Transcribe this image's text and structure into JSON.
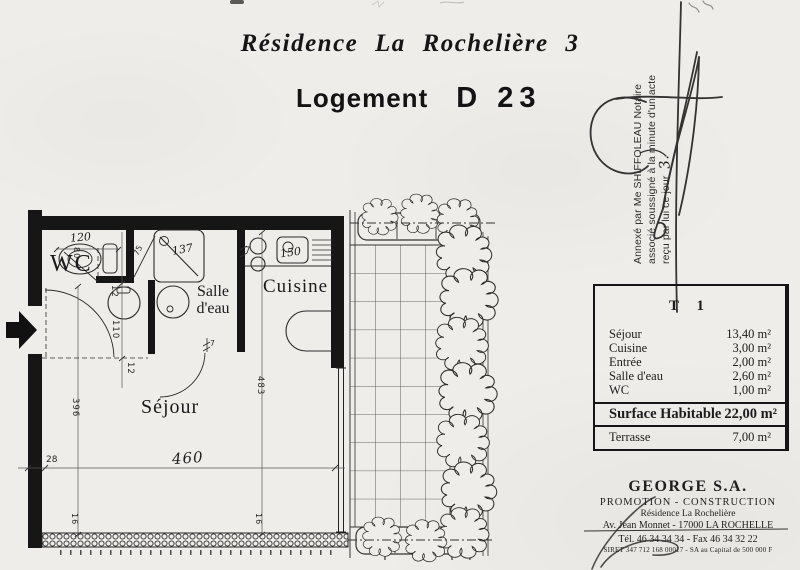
{
  "page": {
    "title": "Résidence La Rochelière 3",
    "logement_label": "Logement",
    "logement_number": "D 23"
  },
  "notary": {
    "line1": "Annexé par Me SHIFFOLEAU Notaire",
    "line2": "associé soussigné à la minute d'un acte",
    "line3": "reçu par lui ce jour",
    "handwritten": "3."
  },
  "plan": {
    "labels": {
      "wc": "WC",
      "salle_line1": "Salle",
      "salle_line2": "d'eau",
      "cuisine": "Cuisine",
      "sejour": "Séjour"
    },
    "dims": {
      "toilet_width": "120",
      "toilet_depth": "80",
      "door_wc": "75",
      "shower": "137",
      "wall_a": "7",
      "sink": "150",
      "d12_top": "12",
      "entry_width": "110",
      "d12_bottom": "12",
      "entry_height": "396",
      "sejour_height": "483",
      "sejour_width": "460",
      "d28": "28",
      "window_left": "16",
      "window_right": "16",
      "wall_b": "7"
    }
  },
  "table": {
    "header": "T 1",
    "rows": [
      {
        "label": "Séjour",
        "value": "13,40 m²"
      },
      {
        "label": "Cuisine",
        "value": "3,00 m²"
      },
      {
        "label": "Entrée",
        "value": "2,00 m²"
      },
      {
        "label": "Salle d'eau",
        "value": "2,60 m²"
      },
      {
        "label": "WC",
        "value": "1,00 m²"
      }
    ],
    "total": {
      "label": "Surface Habitable",
      "value": "22,00 m²"
    },
    "terrace": {
      "label": "Terrasse",
      "value": "7,00 m²"
    }
  },
  "company": {
    "name": "GEORGE S.A.",
    "activity": "PROMOTION - CONSTRUCTION",
    "residence": "Résidence La Rochelière",
    "address": "Av. Jean Monnet - 17000 LA ROCHELLE",
    "phone": "Tél. 46 34 34 34 - Fax 46 34 32 22",
    "siret": "SIRET 347 712 168 00017 - SA au Capital de 500 000 F"
  },
  "colors": {
    "paper": "#efede9",
    "ink": "#1b1b1b"
  }
}
